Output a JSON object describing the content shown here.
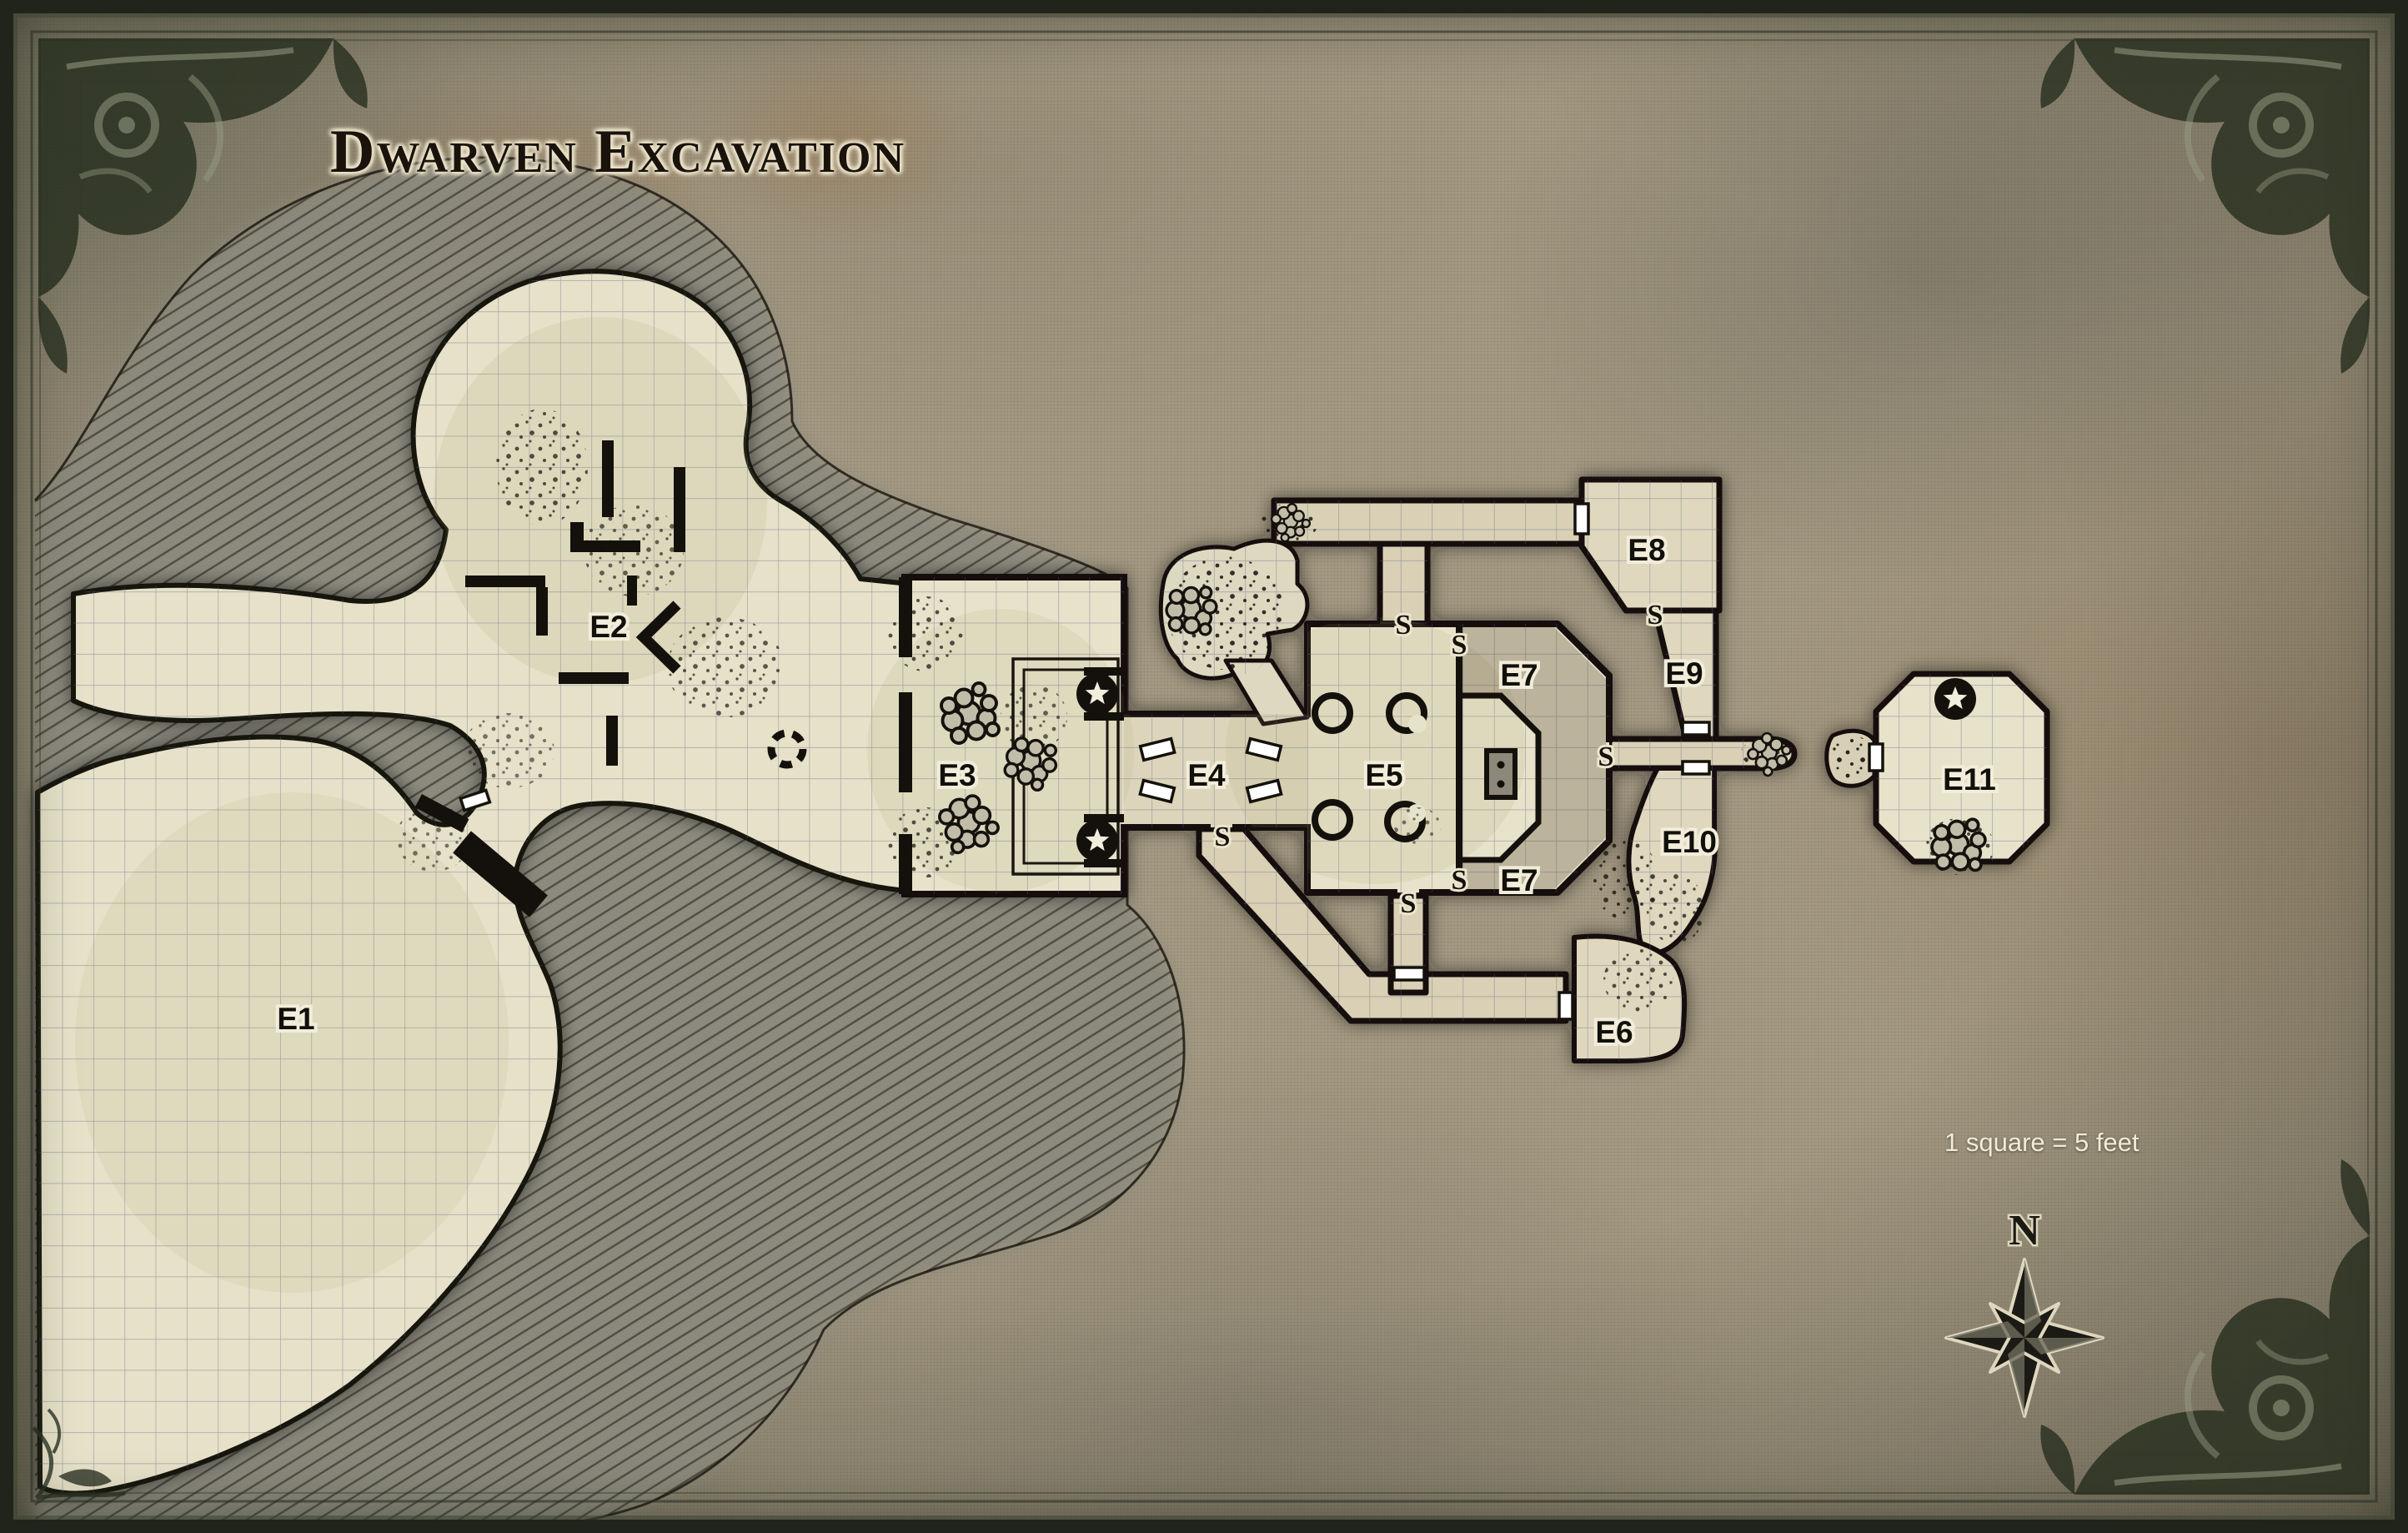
{
  "title": "Dwarven Excavation",
  "scale_note": "1 square = 5 feet",
  "compass": {
    "north_label": "N"
  },
  "map": {
    "secret_door_marker": "S",
    "room_labels": [
      "E1",
      "E2",
      "E3",
      "E4",
      "E5",
      "E6",
      "E7",
      "E7",
      "E8",
      "E9",
      "E10",
      "E11"
    ],
    "colors": {
      "parchment": "#a59a83",
      "floor": "#e7e2ca",
      "corridor_floor": "#d9d0b5",
      "rock": "#8b8a7e",
      "wall": "#14110c",
      "door": "#ffffff",
      "border": "#20241b"
    }
  }
}
